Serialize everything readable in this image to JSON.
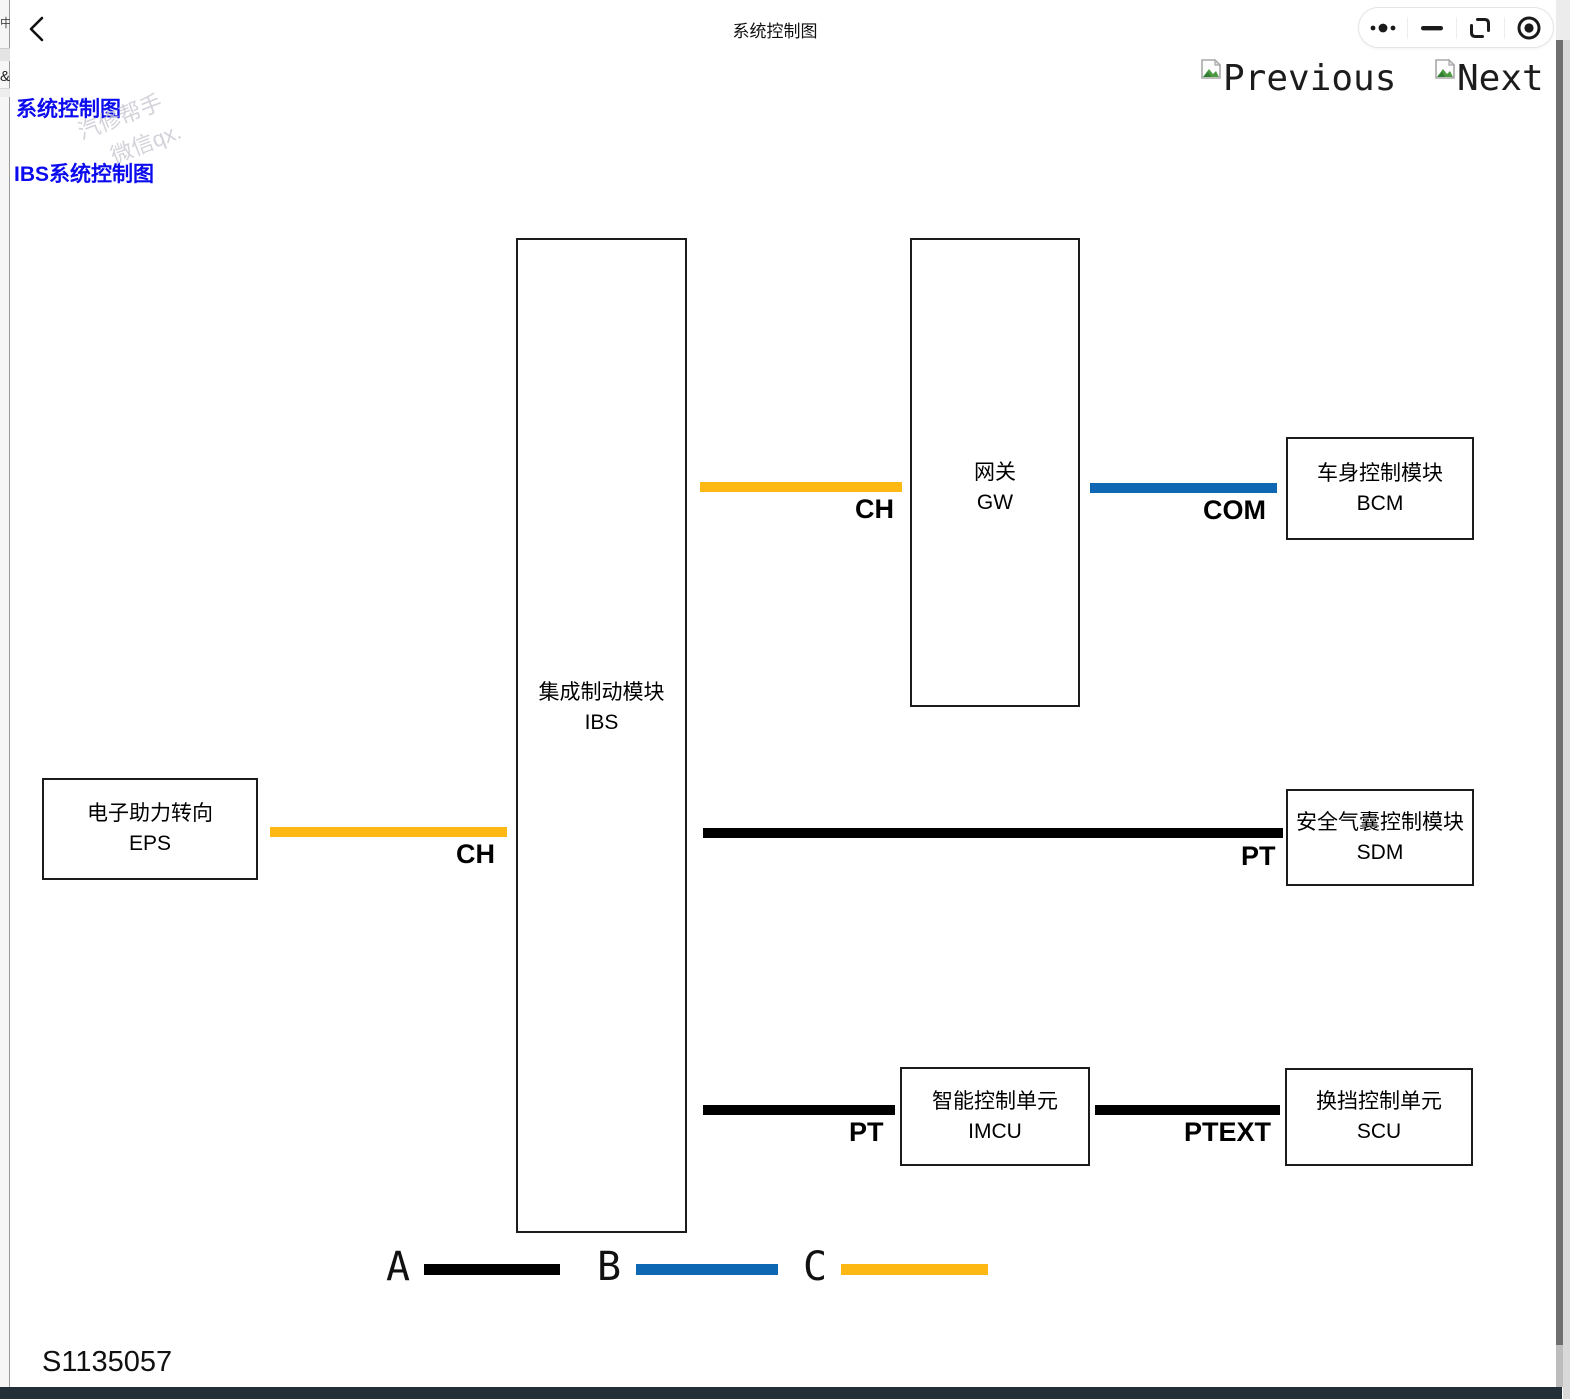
{
  "app": {
    "title": "系统控制图"
  },
  "capsule": {
    "more": "more-icon",
    "minimize": "minimize-icon",
    "relaunch": "relaunch-icon",
    "target": "target-icon"
  },
  "nav": {
    "previous": "Previous",
    "next": "Next"
  },
  "sidebar_links": [
    {
      "label": "系统控制图"
    },
    {
      "label": "IBS系统控制图"
    }
  ],
  "watermark": {
    "line1": "汽修帮手",
    "line2": "微信qx."
  },
  "edge_fragments": {
    "left_top": "中/",
    "left_mid": "&"
  },
  "diagram": {
    "nodes": [
      {
        "id": "eps",
        "line1": "电子助力转向",
        "line2": "EPS"
      },
      {
        "id": "ibs",
        "line1": "集成制动模块",
        "line2": "IBS"
      },
      {
        "id": "gw",
        "line1": "网关",
        "line2": "GW"
      },
      {
        "id": "bcm",
        "line1": "车身控制模块",
        "line2": "BCM"
      },
      {
        "id": "sdm",
        "line1": "安全气囊控制模块",
        "line2": "SDM"
      },
      {
        "id": "imcu",
        "line1": "智能控制单元",
        "line2": "IMCU"
      },
      {
        "id": "scu",
        "line1": "换挡控制单元",
        "line2": "SCU"
      }
    ],
    "connection_labels": {
      "eps_ibs": "CH",
      "ibs_gw": "CH",
      "gw_bcm": "COM",
      "ibs_sdm": "PT",
      "ibs_imcu": "PT",
      "imcu_scu": "PTEXT"
    },
    "legend": [
      {
        "label": "A",
        "color": "#000000"
      },
      {
        "label": "B",
        "color": "#0E67B2"
      },
      {
        "label": "C",
        "color": "#FDB813"
      }
    ],
    "figure_id": "S1135057"
  },
  "colors": {
    "line_black": "#000000",
    "line_blue": "#0E67B2",
    "line_yellow": "#FDB813",
    "link_blue": "#0B0BEE",
    "bottom_bar": "#233038"
  }
}
